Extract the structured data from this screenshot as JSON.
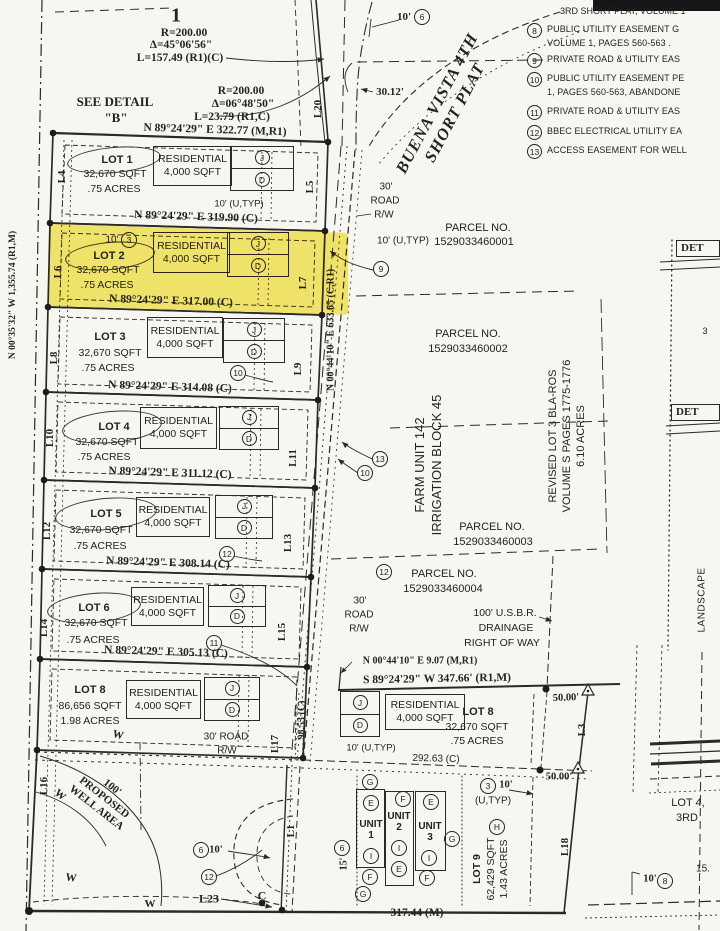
{
  "sheet": {
    "number": "1"
  },
  "plat_name": {
    "line1": "BUENA VISTA 4TH",
    "line2": "SHORT PLAT"
  },
  "legend": {
    "heading": "3RD SHORT PLAT, VOLUME 1",
    "items": [
      {
        "num": "8",
        "line1": "PUBLIC UTILITY EASEMENT G",
        "line2": "VOLUME 1, PAGES 560-563 ."
      },
      {
        "num": "9",
        "line1": "PRIVATE ROAD & UTILITY EAS",
        "line2": ""
      },
      {
        "num": "10",
        "line1": "PUBLIC UTILITY EASEMENT PE",
        "line2": "1, PAGES 560-563, ABANDONE"
      },
      {
        "num": "11",
        "line1": "PRIVATE ROAD & UTILITY EAS",
        "line2": ""
      },
      {
        "num": "12",
        "line1": "BBEC ELECTRICAL UTILITY EA",
        "line2": ""
      },
      {
        "num": "13",
        "line1": "ACCESS EASEMENT FOR WELL",
        "line2": ""
      }
    ]
  },
  "curves": {
    "c1_r": "R=200.00",
    "c1_delta": "Δ=45°06'56\"",
    "c1_len": "L=157.49 (R1)(C)",
    "c2_r": "R=200.00",
    "c2_delta": "Δ=06°48'50\"",
    "c2_len": "L=23.79 (R1,C)"
  },
  "notes": {
    "see_detail": "SEE DETAIL",
    "detail_b": "\"B\""
  },
  "boundary": {
    "north": "N 89°24'29\" E 322.77 (M,R1)",
    "west": "N 00°35'32\" W 1,355.74 (R1,M)",
    "road": "N 00°44'10\" E 633.65 (C,R1)",
    "south": "317.44 (M)",
    "lot8_jog": "N 00°44'10\" E 9.07 (M,R1)",
    "lot8_south": "S 89°24'29\" W 347.66' (R1,M)",
    "road_inner": "98.53 (C)",
    "lot9_north": "292.63 (C)",
    "dim_50_a": "50.00'",
    "dim_50_b": "50.00'",
    "dim_3012": "30.12'",
    "dim_10": "10'",
    "dim_15": "15'"
  },
  "residential": {
    "line1": "RESIDENTIAL",
    "line2": "4,000 SQFT"
  },
  "lots": [
    {
      "name": "LOT 1",
      "sqft": "32,670 SQFT",
      "acres": ".75 ACRES",
      "bearing": "N 89°24'29\" E 319.90 (C)",
      "left": "L4",
      "right": "L5",
      "note": "10' (U,TYP)"
    },
    {
      "name": "LOT 2",
      "sqft": "32,670 SQFT",
      "acres": ".75 ACRES",
      "bearing": "N 89°24'29\" E 317.00 (C)",
      "left": "L6",
      "right": "L7",
      "note": "10'"
    },
    {
      "name": "LOT 3",
      "sqft": "32,670 SQFT",
      "acres": ".75 ACRES",
      "bearing": "N 89°24'29\" E 314.08 (C)",
      "left": "L8",
      "right": "L9",
      "note": ""
    },
    {
      "name": "LOT 4",
      "sqft": "32,670 SQFT",
      "acres": ".75 ACRES",
      "bearing": "N 89°24'29\" E 311.12 (C)",
      "left": "L10",
      "right": "L11",
      "note": ""
    },
    {
      "name": "LOT 5",
      "sqft": "32,670 SQFT",
      "acres": ".75 ACRES",
      "bearing": "N 89°24'29\" E 308.14 (C)",
      "left": "L12",
      "right": "L13",
      "note": ""
    },
    {
      "name": "LOT 6",
      "sqft": "32,670 SQFT",
      "acres": ".75 ACRES",
      "bearing": "N 89°24'29\" E 305.13 (C)",
      "left": "L14",
      "right": "L15",
      "note": ""
    },
    {
      "name": "LOT 8",
      "sqft": "86,656 SQFT",
      "acres": "1.98 ACRES",
      "bearing": "",
      "left": "L16",
      "right": "L17",
      "note": ""
    }
  ],
  "lot8_east": {
    "name": "LOT 8",
    "sqft": "32,670 SQFT",
    "acres": ".75 ACRES"
  },
  "lot9": {
    "name": "LOT 9",
    "sqft": "62,429 SQFT",
    "acres": "1.43 ACRES"
  },
  "units": {
    "u1": "UNIT 1",
    "u2": "UNIT 2",
    "u3": "UNIT 3"
  },
  "east": {
    "road_r1": "30'",
    "road_r2": "ROAD",
    "road_r3": "R/W",
    "parcel_no": "PARCEL NO.",
    "utyp": "10' (U,TYP)",
    "p1": "1529033460001",
    "p2": "1529033460002",
    "p3": "1529033460003",
    "p4": "1529033460004",
    "farm": "FARM UNIT 142",
    "irrigation": "IRRIGATION BLOCK 45",
    "rev1": "REVISED LOT 3 BLA-ROS",
    "rev2": "VOLUME S PAGES 1775-1776",
    "rev3": "6.10 ACRES",
    "usbr1": "100' U.S.B.R.",
    "usbr2": "DRAINAGE",
    "usbr3": "RIGHT OF WAY"
  },
  "west_area": {
    "well1": "100'",
    "well2": "PROPOSED",
    "well3": "WELL AREA",
    "w": "W",
    "road30": "30' ROAD",
    "rw": "R/W"
  },
  "edge": {
    "det": "DET",
    "landscape": "LANDSCAPE",
    "frag3": "3",
    "lot4a": "LOT 4,",
    "lot4b": "3RD",
    "frag15": "15.",
    "utyp_s": "(U,TYP)",
    "c": "C"
  },
  "labels": {
    "L1": "L1",
    "L3": "L3",
    "L4": "L4",
    "L5": "L5",
    "L6": "L6",
    "L7": "L7",
    "L8": "L8",
    "L9": "L9",
    "L10": "L10",
    "L11": "L11",
    "L12": "L12",
    "L13": "L13",
    "L14": "L14",
    "L15": "L15",
    "L16": "L16",
    "L17": "L17",
    "L18": "L18",
    "L20": "L20",
    "L23": "L23"
  },
  "markers": {
    "m3": "3",
    "m6": "6",
    "m8": "8",
    "m9": "9",
    "m10": "10",
    "m11": "11",
    "m12": "12",
    "m13": "13"
  },
  "letters": {
    "J": "J",
    "D": "D",
    "E": "E",
    "F": "F",
    "G": "G",
    "H": "H",
    "I": "I"
  }
}
